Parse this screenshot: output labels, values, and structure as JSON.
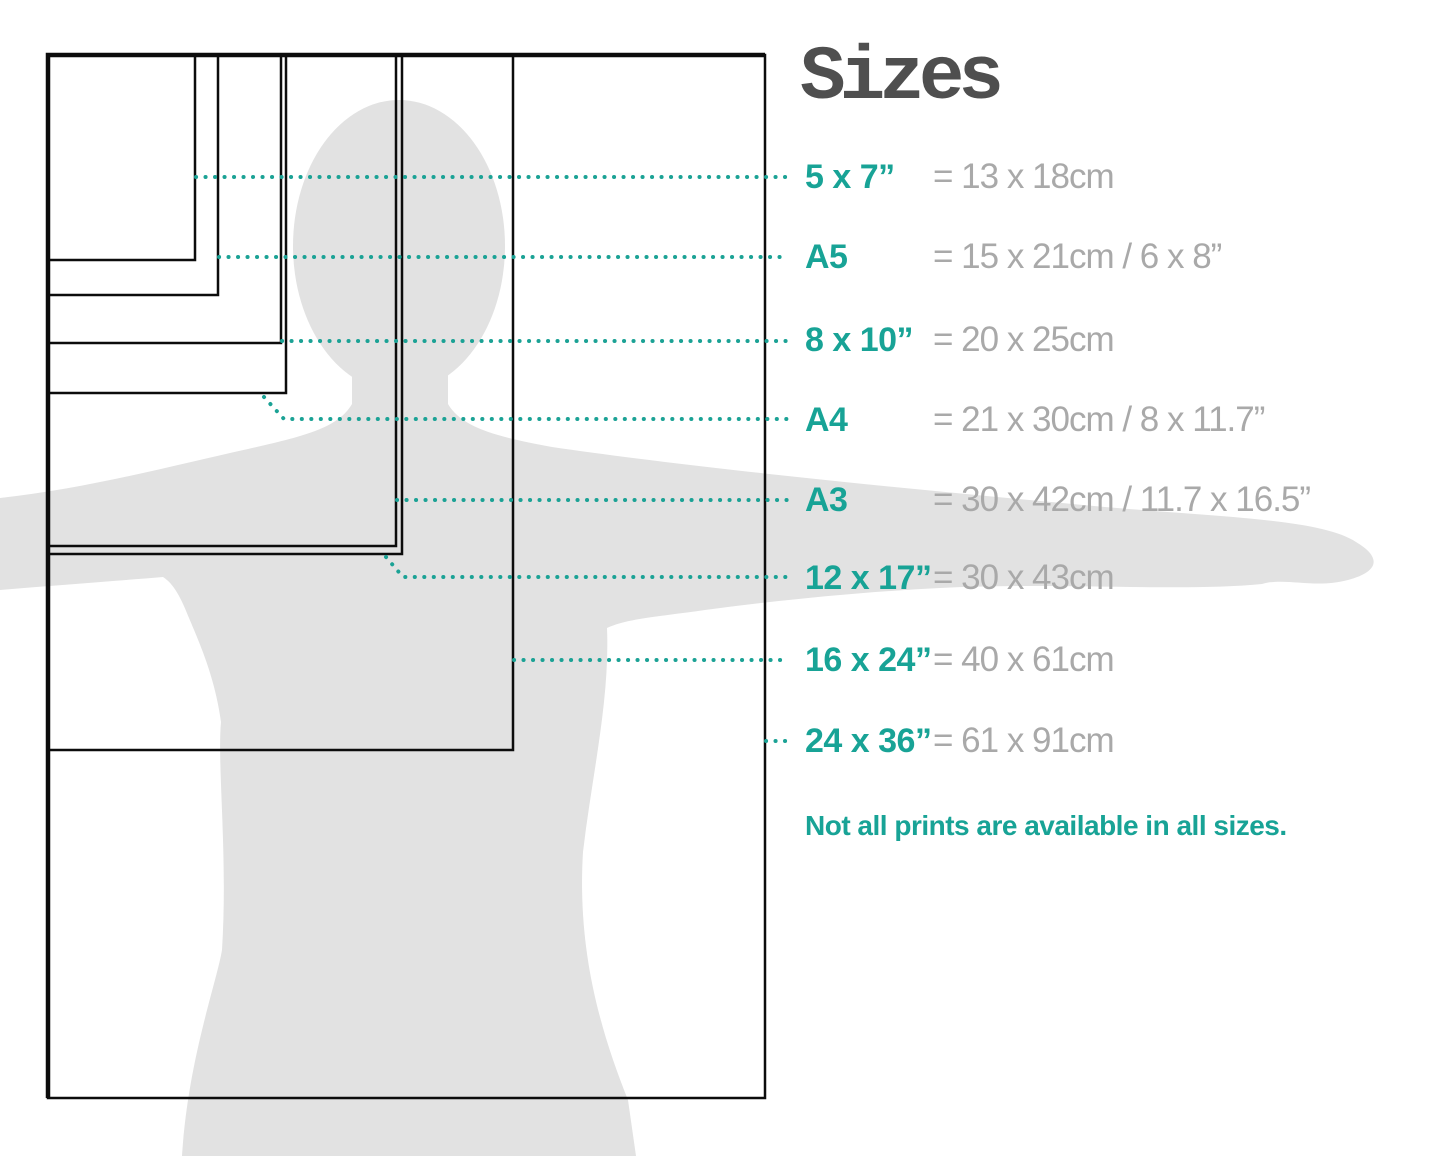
{
  "title": "Sizes",
  "note": "Not all prints are available in all sizes.",
  "colors": {
    "accent_teal": "#18a396",
    "metric_gray": "#a9a9a9",
    "title_gray": "#4f4f4f",
    "silhouette_gray": "#e2e2e2",
    "outline_black": "#0c0c0c"
  },
  "sizes": [
    {
      "label": "5 x 7”",
      "metric": "= 13 x 18cm"
    },
    {
      "label": "A5",
      "metric": "= 15 x 21cm / 6 x 8”"
    },
    {
      "label": "8 x 10”",
      "metric": "= 20 x 25cm"
    },
    {
      "label": "A4",
      "metric": "= 21 x 30cm / 8 x 11.7”"
    },
    {
      "label": "A3",
      "metric": "= 30 x 42cm / 11.7 x 16.5”"
    },
    {
      "label": "12 x 17”",
      "metric": "= 30 x 43cm"
    },
    {
      "label": "16 x 24”",
      "metric": "= 40 x 61cm"
    },
    {
      "label": "24 x 36”",
      "metric": "= 61 x 91cm"
    }
  ]
}
